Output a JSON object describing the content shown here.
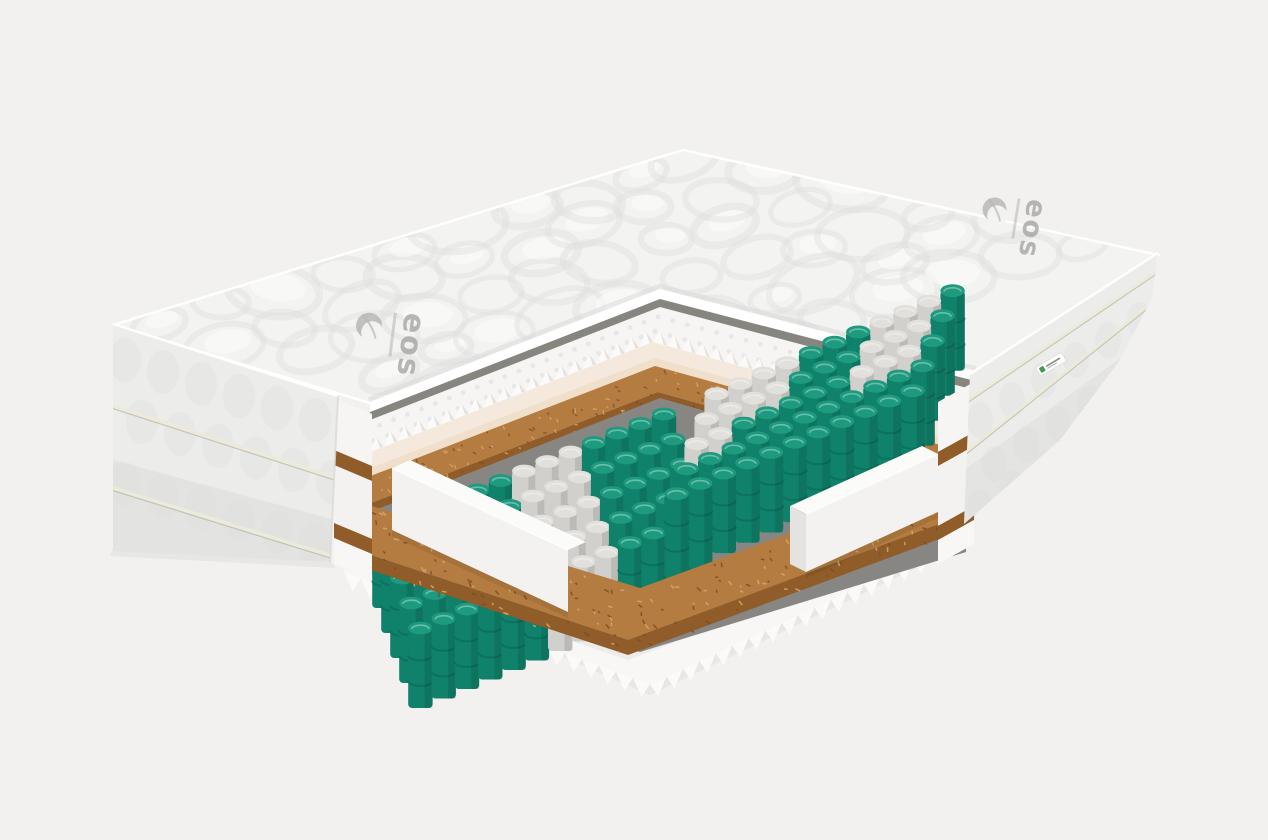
{
  "scene": {
    "type": "product-render",
    "subject": "mattress interior cutaway cross-section",
    "background": "#f2f1ef"
  },
  "brand": {
    "name": "eos",
    "logo_color": "#a6a6a2"
  },
  "side_label": {
    "kind": "small-fabric-tag",
    "base": "#ffffff",
    "accent": "#3f9e4f",
    "text_mark": "#6b6b67"
  },
  "layers": [
    {
      "name": "quilted-top-cover"
    },
    {
      "name": "convoluted-foam-top"
    },
    {
      "name": "coconut-coir-top"
    },
    {
      "name": "pocket-spring-unit"
    },
    {
      "name": "foam-edge-rails"
    },
    {
      "name": "coconut-coir-bottom"
    },
    {
      "name": "convoluted-foam-bottom"
    }
  ],
  "colors": {
    "bg": "#f2f1ef",
    "quiltTop": "#f3f3f1",
    "quiltBlob": "#e1e1df",
    "quiltHighlight": "#fbfbfa",
    "quiltEdgeShade": "#d8d8d6",
    "coverRim": "#ffffff",
    "coverUnderside": "#86857f",
    "eggWhite": "#f6f5f3",
    "eggDot": "#e8e6e3",
    "eggToothLit": "#fbfaf8",
    "eggToothShade": "#d9d7d3",
    "eggCut": "#f5e9dd",
    "eggCutDeep": "#efdcc6",
    "coirTop": "#b57c41",
    "coirLight": "#d7a86b",
    "coirDark": "#7d4e22",
    "coirCut": "#8f5c2a",
    "springBase": "#878682",
    "springTeal": "#10816a",
    "springTealTop": "#1e9a7f",
    "springTealDark": "#0a6454",
    "springGray": "#d2d0cc",
    "springGrayTop": "#e2e0dc",
    "springGrayDark": "#aeaca8",
    "railTop": "#fbfbf9",
    "railFront": "#f3f2f0",
    "railEnd": "#e4e3e1",
    "bottomFoam": "#f8f7f5",
    "bottomFoamShade": "#e6e5e2",
    "zigShade": "#d8d6d2",
    "panel": "#ececea",
    "panelShade": "#d9d9d7",
    "panelBump": "#e2e2e0",
    "piping": "#eceadb",
    "pipingShadow": "#b7b5a6",
    "groundShadow": "#dededc",
    "logoGray": "#a6a6a2"
  }
}
